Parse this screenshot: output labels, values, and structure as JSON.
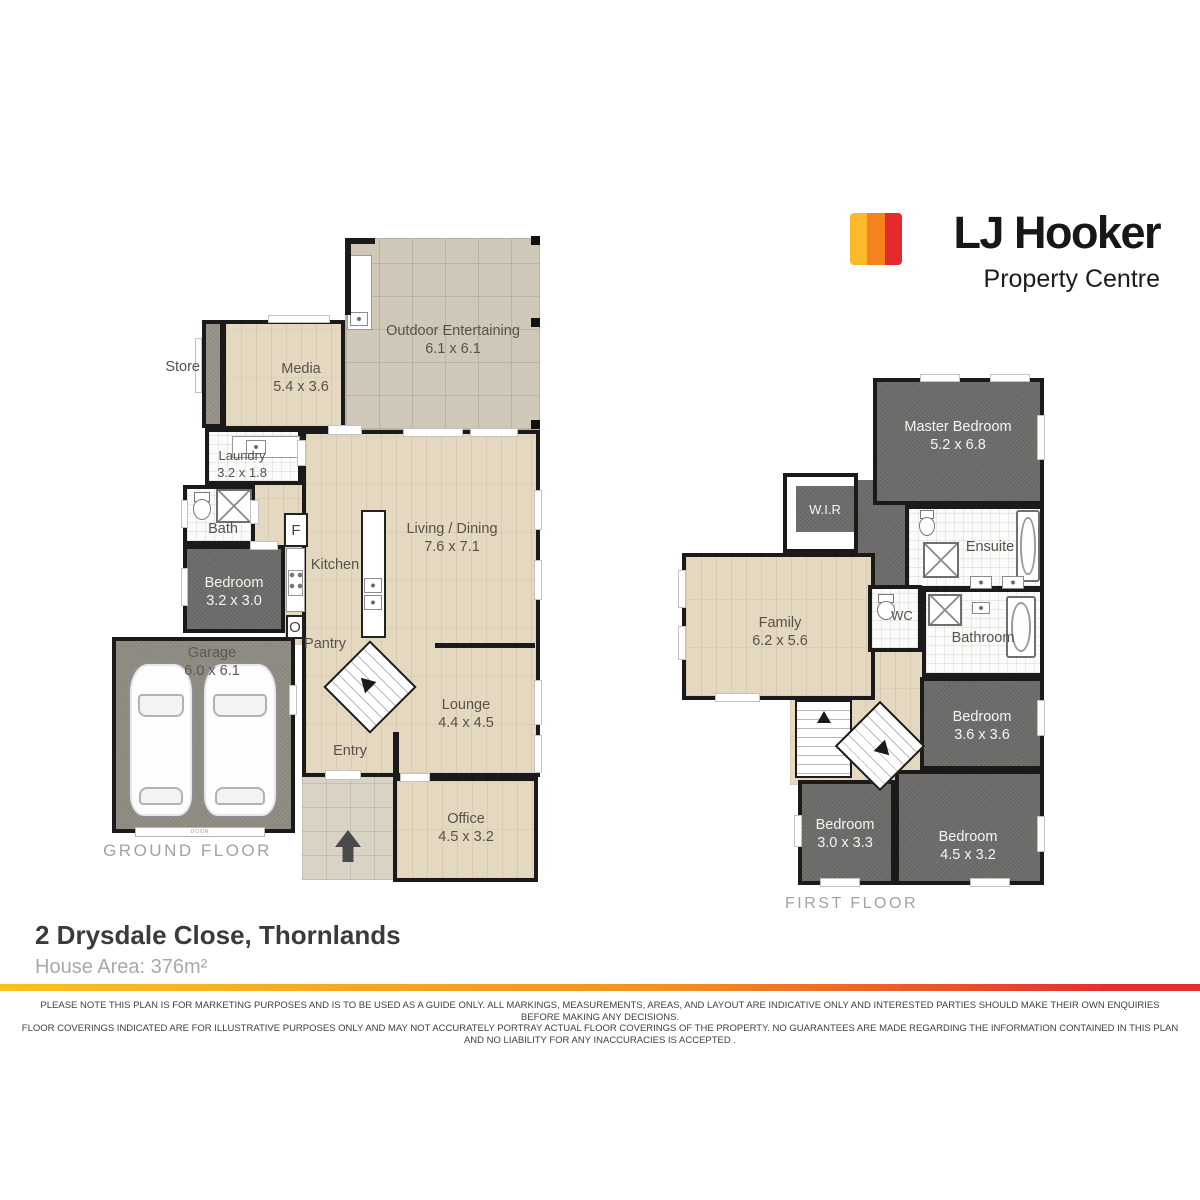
{
  "logo": {
    "brand": "LJ Hooker",
    "subtitle": "Property Centre",
    "colors": [
      "#FDB92C",
      "#F3821F",
      "#E52A2E"
    ]
  },
  "address": {
    "title": "2 Drysdale Close, Thornlands",
    "house_area": "House Area: 376m²"
  },
  "divider": {
    "gradient": [
      "#F7C221",
      "#F29222 55%",
      "#E63030 92%"
    ]
  },
  "disclaimer": {
    "line1": "PLEASE NOTE THIS PLAN IS FOR MARKETING PURPOSES AND IS TO BE USED AS A GUIDE ONLY.  ALL MARKINGS, MEASUREMENTS, AREAS, AND LAYOUT ARE INDICATIVE ONLY AND INTERESTED PARTIES SHOULD MAKE THEIR OWN ENQUIRIES BEFORE MAKING ANY DECISIONS.",
    "line2": "FLOOR COVERINGS INDICATED ARE FOR ILLUSTRATIVE PURPOSES ONLY AND MAY NOT ACCURATELY PORTRAY ACTUAL FLOOR COVERINGS OF THE PROPERTY.  NO GUARANTEES ARE MADE REGARDING THE INFORMATION CONTAINED IN THIS PLAN AND NO LIABILITY FOR  ANY INACCURACIES IS ACCEPTED ."
  },
  "floorplans": [
    {
      "id": "ground-floor-plan",
      "title": "GROUND FLOOR",
      "x": 100,
      "y": 230,
      "w": 470,
      "h": 680,
      "areas": [
        {
          "id": "porch",
          "surface": "porchtile",
          "bordered": false,
          "x": 202,
          "y": 547,
          "w": 91,
          "h": 103
        },
        {
          "id": "hall",
          "surface": "wood",
          "bordered": false,
          "x": 153,
          "y": 255,
          "w": 52,
          "h": 62
        },
        {
          "id": "kitchen-nook",
          "surface": "wood",
          "bordered": false,
          "x": 185,
          "y": 315,
          "w": 18,
          "h": 100
        },
        {
          "id": "outdoor-entertaining",
          "surface": "outdoor",
          "bordered": false,
          "outlined": true,
          "x": 245,
          "y": 8,
          "w": 195,
          "h": 192
        },
        {
          "id": "store",
          "surface": "store",
          "bordered": true,
          "x": 102,
          "y": 90,
          "w": 22,
          "h": 108
        },
        {
          "id": "media",
          "surface": "wood",
          "bordered": true,
          "x": 122,
          "y": 90,
          "w": 123,
          "h": 110
        },
        {
          "id": "laundry",
          "surface": "tile",
          "bordered": true,
          "x": 105,
          "y": 198,
          "w": 97,
          "h": 57
        },
        {
          "id": "bath",
          "surface": "tile",
          "bordered": true,
          "x": 83,
          "y": 255,
          "w": 72,
          "h": 60
        },
        {
          "id": "bedroom-ground",
          "surface": "carpet",
          "bordered": true,
          "x": 83,
          "y": 315,
          "w": 102,
          "h": 88
        },
        {
          "id": "garage",
          "surface": "garage",
          "bordered": true,
          "x": 12,
          "y": 407,
          "w": 183,
          "h": 196
        },
        {
          "id": "living-dining",
          "surface": "wood",
          "bordered": true,
          "x": 202,
          "y": 200,
          "w": 238,
          "h": 347
        },
        {
          "id": "office",
          "surface": "wood",
          "bordered": true,
          "x": 293,
          "y": 547,
          "w": 145,
          "h": 105
        }
      ],
      "walls": [
        {
          "x": 335,
          "y": 413,
          "w": 100,
          "h": 5
        },
        {
          "x": 293,
          "y": 502,
          "w": 6,
          "h": 45
        },
        {
          "x": 245,
          "y": 8,
          "w": 6,
          "h": 77
        },
        {
          "x": 245,
          "y": 8,
          "w": 30,
          "h": 6
        }
      ],
      "windows": [
        {
          "x": 168,
          "y": 85,
          "w": 62,
          "h": 8
        },
        {
          "x": 95,
          "y": 108,
          "w": 7,
          "h": 55
        },
        {
          "x": 81,
          "y": 270,
          "w": 7,
          "h": 28
        },
        {
          "x": 81,
          "y": 338,
          "w": 7,
          "h": 38
        },
        {
          "x": 303,
          "y": 198,
          "w": 60,
          "h": 9
        },
        {
          "x": 370,
          "y": 198,
          "w": 48,
          "h": 9
        },
        {
          "x": 434,
          "y": 260,
          "w": 8,
          "h": 40
        },
        {
          "x": 434,
          "y": 330,
          "w": 8,
          "h": 40
        },
        {
          "x": 434,
          "y": 450,
          "w": 8,
          "h": 45
        },
        {
          "x": 434,
          "y": 505,
          "w": 8,
          "h": 38
        },
        {
          "x": 225,
          "y": 540,
          "w": 36,
          "h": 10
        },
        {
          "x": 300,
          "y": 543,
          "w": 30,
          "h": 9
        },
        {
          "x": 189,
          "y": 455,
          "w": 8,
          "h": 30
        },
        {
          "x": 150,
          "y": 311,
          "w": 28,
          "h": 9
        },
        {
          "x": 197,
          "y": 210,
          "w": 9,
          "h": 26
        },
        {
          "x": 150,
          "y": 270,
          "w": 9,
          "h": 24
        },
        {
          "x": 228,
          "y": 195,
          "w": 34,
          "h": 10
        }
      ],
      "fixtures": [
        {
          "type": "bench",
          "x": 247,
          "y": 25,
          "w": 25,
          "h": 75
        },
        {
          "type": "sink",
          "x": 250,
          "y": 82,
          "w": 18,
          "h": 14
        },
        {
          "type": "post",
          "x": 431,
          "y": 6,
          "w": 9,
          "h": 9
        },
        {
          "type": "post",
          "x": 431,
          "y": 88,
          "w": 9,
          "h": 9
        },
        {
          "type": "post",
          "x": 431,
          "y": 190,
          "w": 9,
          "h": 9
        },
        {
          "type": "bench",
          "x": 132,
          "y": 206,
          "w": 68,
          "h": 22
        },
        {
          "type": "sink",
          "x": 146,
          "y": 210,
          "w": 20,
          "h": 14
        },
        {
          "type": "toilet",
          "x": 92,
          "y": 262,
          "w": 20,
          "h": 28
        },
        {
          "type": "shower",
          "x": 116,
          "y": 259,
          "w": 36,
          "h": 34
        },
        {
          "type": "box",
          "text": "F",
          "x": 184,
          "y": 283,
          "w": 24,
          "h": 34
        },
        {
          "type": "counter",
          "x": 186,
          "y": 318,
          "w": 19,
          "h": 64
        },
        {
          "type": "cooktop",
          "x": 188,
          "y": 340,
          "w": 15,
          "h": 26
        },
        {
          "type": "box",
          "text": "O",
          "x": 186,
          "y": 385,
          "w": 18,
          "h": 24
        },
        {
          "type": "box",
          "text": "",
          "x": 261,
          "y": 280,
          "w": 25,
          "h": 128
        },
        {
          "type": "sink",
          "x": 264,
          "y": 348,
          "w": 18,
          "h": 15
        },
        {
          "type": "sink",
          "x": 264,
          "y": 365,
          "w": 18,
          "h": 15
        },
        {
          "type": "stairs",
          "dir": "left",
          "rot": true,
          "x": 237,
          "y": 424,
          "w": 66,
          "h": 66
        },
        {
          "type": "car",
          "x": 28,
          "y": 432,
          "w": 66,
          "h": 156
        },
        {
          "type": "car",
          "x": 102,
          "y": 432,
          "w": 76,
          "h": 156
        },
        {
          "type": "doorstrip",
          "text": "DOOR",
          "x": 35,
          "y": 597,
          "w": 130,
          "h": 10
        },
        {
          "type": "bigarrow",
          "x": 234,
          "y": 600,
          "w": 28,
          "h": 40
        }
      ],
      "labels": [
        {
          "id": "label-store",
          "lines": [
            "Store"
          ],
          "x": 20,
          "y": 128,
          "w": 80,
          "align": "right"
        },
        {
          "id": "label-media",
          "lines": [
            "Media",
            "5.4 x 3.6"
          ],
          "x": 101,
          "y": 130,
          "w": 200
        },
        {
          "id": "label-outdoor",
          "lines": [
            "Outdoor Entertaining",
            "6.1 x 6.1"
          ],
          "x": 253,
          "y": 92,
          "w": 200
        },
        {
          "id": "label-laundry",
          "lines": [
            "Laundry",
            "3.2 x 1.8"
          ],
          "x": 92,
          "y": 217,
          "w": 100,
          "size": 13
        },
        {
          "id": "label-bath",
          "lines": [
            "Bath"
          ],
          "x": 73,
          "y": 290,
          "w": 100
        },
        {
          "id": "label-bedroom-ground",
          "lines": [
            "Bedroom",
            "3.2 x 3.0"
          ],
          "x": 84,
          "y": 344,
          "w": 100,
          "color": "#f4f4f4"
        },
        {
          "id": "label-kitchen",
          "lines": [
            "Kitchen"
          ],
          "x": 195,
          "y": 326,
          "w": 80
        },
        {
          "id": "label-living-dining",
          "lines": [
            "Living / Dining",
            "7.6 x 7.1"
          ],
          "x": 252,
          "y": 290,
          "w": 200
        },
        {
          "id": "label-garage",
          "lines": [
            "Garage",
            "6.0 x 6.1"
          ],
          "x": 12,
          "y": 414,
          "w": 200,
          "color": "#5d5952"
        },
        {
          "id": "label-pantry",
          "lines": [
            "Pantry"
          ],
          "x": 185,
          "y": 405,
          "w": 80
        },
        {
          "id": "label-entry",
          "lines": [
            "Entry"
          ],
          "x": 200,
          "y": 512,
          "w": 100
        },
        {
          "id": "label-lounge",
          "lines": [
            "Lounge",
            "4.4 x 4.5"
          ],
          "x": 266,
          "y": 466,
          "w": 200
        },
        {
          "id": "label-office",
          "lines": [
            "Office",
            "4.5 x 3.2"
          ],
          "x": 266,
          "y": 580,
          "w": 200
        },
        {
          "id": "floor-title",
          "lines": [
            "GROUND FLOOR"
          ],
          "x": 0,
          "y": 610,
          "w": 175,
          "color": "#a2a2a2",
          "size": 17,
          "ls": 2.5
        }
      ]
    },
    {
      "id": "first-floor-plan",
      "title": "FIRST FLOOR",
      "x": 670,
      "y": 370,
      "w": 380,
      "h": 545,
      "areas": [
        {
          "id": "hallway",
          "surface": "carpet",
          "bordered": false,
          "x": 188,
          "y": 110,
          "w": 50,
          "h": 170
        },
        {
          "id": "landing",
          "surface": "wood",
          "bordered": false,
          "x": 120,
          "y": 280,
          "w": 160,
          "h": 135
        },
        {
          "id": "master-bedroom",
          "surface": "carpet",
          "bordered": true,
          "x": 203,
          "y": 8,
          "w": 171,
          "h": 127
        },
        {
          "id": "wir-surround",
          "surface": "plain",
          "bordered": true,
          "x": 113,
          "y": 103,
          "w": 75,
          "h": 80
        },
        {
          "id": "wir",
          "surface": "carpet",
          "bordered": false,
          "x": 126,
          "y": 116,
          "w": 58,
          "h": 46
        },
        {
          "id": "ensuite",
          "surface": "tile",
          "bordered": true,
          "x": 235,
          "y": 135,
          "w": 139,
          "h": 85
        },
        {
          "id": "family",
          "surface": "wood",
          "bordered": true,
          "x": 12,
          "y": 183,
          "w": 193,
          "h": 147
        },
        {
          "id": "wc",
          "surface": "tile",
          "bordered": true,
          "x": 198,
          "y": 215,
          "w": 54,
          "h": 67
        },
        {
          "id": "bathroom",
          "surface": "tile",
          "bordered": true,
          "x": 252,
          "y": 218,
          "w": 122,
          "h": 89
        },
        {
          "id": "bedroom-36",
          "surface": "carpet",
          "bordered": true,
          "x": 250,
          "y": 307,
          "w": 124,
          "h": 93
        },
        {
          "id": "bedroom-30",
          "surface": "carpet",
          "bordered": true,
          "x": 128,
          "y": 410,
          "w": 97,
          "h": 105
        },
        {
          "id": "bedroom-45",
          "surface": "carpet",
          "bordered": true,
          "x": 225,
          "y": 400,
          "w": 149,
          "h": 115
        }
      ],
      "walls": [],
      "windows": [
        {
          "x": 250,
          "y": 4,
          "w": 40,
          "h": 8
        },
        {
          "x": 320,
          "y": 4,
          "w": 40,
          "h": 8
        },
        {
          "x": 367,
          "y": 45,
          "w": 8,
          "h": 45
        },
        {
          "x": 8,
          "y": 200,
          "w": 8,
          "h": 38
        },
        {
          "x": 8,
          "y": 256,
          "w": 8,
          "h": 34
        },
        {
          "x": 45,
          "y": 323,
          "w": 45,
          "h": 9
        },
        {
          "x": 367,
          "y": 330,
          "w": 8,
          "h": 36
        },
        {
          "x": 367,
          "y": 446,
          "w": 8,
          "h": 36
        },
        {
          "x": 300,
          "y": 508,
          "w": 40,
          "h": 9
        },
        {
          "x": 150,
          "y": 508,
          "w": 40,
          "h": 9
        },
        {
          "x": 124,
          "y": 445,
          "w": 8,
          "h": 32
        }
      ],
      "fixtures": [
        {
          "type": "toilet",
          "x": 248,
          "y": 140,
          "w": 18,
          "h": 26
        },
        {
          "type": "shower",
          "x": 253,
          "y": 172,
          "w": 36,
          "h": 36
        },
        {
          "type": "bathtub",
          "x": 346,
          "y": 140,
          "w": 24,
          "h": 72
        },
        {
          "type": "sink",
          "x": 300,
          "y": 206,
          "w": 22,
          "h": 13
        },
        {
          "type": "sink",
          "x": 332,
          "y": 206,
          "w": 22,
          "h": 13
        },
        {
          "type": "toilet",
          "x": 206,
          "y": 224,
          "w": 20,
          "h": 26
        },
        {
          "type": "shower",
          "x": 258,
          "y": 224,
          "w": 34,
          "h": 32
        },
        {
          "type": "bathtub",
          "x": 336,
          "y": 226,
          "w": 30,
          "h": 62
        },
        {
          "type": "sink",
          "x": 302,
          "y": 232,
          "w": 18,
          "h": 12
        },
        {
          "type": "stairs",
          "dir": "up",
          "x": 125,
          "y": 330,
          "w": 57,
          "h": 78
        },
        {
          "type": "stairs",
          "dir": "right",
          "rot": true,
          "x": 178,
          "y": 344,
          "w": 64,
          "h": 64
        }
      ],
      "labels": [
        {
          "id": "label-master",
          "lines": [
            "Master Bedroom",
            "5.2 x 6.8"
          ],
          "x": 188,
          "y": 48,
          "w": 200,
          "color": "#f4f4f4"
        },
        {
          "id": "label-wir",
          "lines": [
            "W.I.R"
          ],
          "x": 105,
          "y": 131,
          "w": 100,
          "color": "#f4f4f4",
          "size": 13
        },
        {
          "id": "label-ensuite",
          "lines": [
            "Ensuite"
          ],
          "x": 270,
          "y": 168,
          "w": 100
        },
        {
          "id": "label-family",
          "lines": [
            "Family",
            "6.2 x 5.6"
          ],
          "x": 10,
          "y": 244,
          "w": 200
        },
        {
          "id": "label-wc",
          "lines": [
            "WC"
          ],
          "x": 205,
          "y": 237,
          "w": 54,
          "size": 13
        },
        {
          "id": "label-bathroom",
          "lines": [
            "Bathroom"
          ],
          "x": 263,
          "y": 259,
          "w": 100
        },
        {
          "id": "label-bedroom-36",
          "lines": [
            "Bedroom",
            "3.6 x 3.6"
          ],
          "x": 212,
          "y": 338,
          "w": 200,
          "color": "#f4f4f4"
        },
        {
          "id": "label-bedroom-30",
          "lines": [
            "Bedroom",
            "3.0 x 3.3"
          ],
          "x": 75,
          "y": 446,
          "w": 200,
          "color": "#f4f4f4"
        },
        {
          "id": "label-bedroom-45",
          "lines": [
            "Bedroom",
            "4.5 x 3.2"
          ],
          "x": 198,
          "y": 458,
          "w": 200,
          "color": "#f4f4f4"
        },
        {
          "id": "floor-title",
          "lines": [
            "FIRST FLOOR"
          ],
          "x": 104,
          "y": 524,
          "w": 155,
          "color": "#a2a2a2",
          "size": 16,
          "ls": 2.5
        }
      ]
    }
  ]
}
